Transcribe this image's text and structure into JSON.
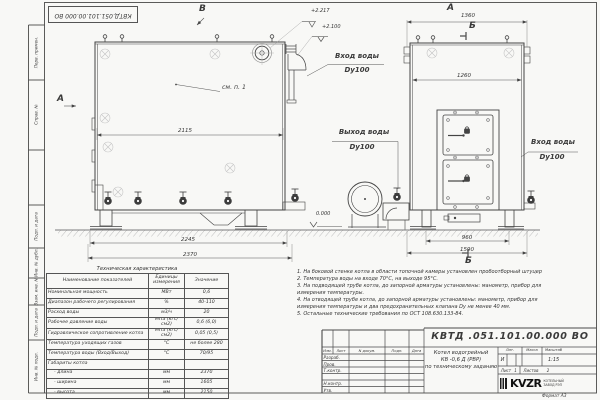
{
  "sheet": {
    "stamp_top": "КВТД.051.101.00.000 ВО",
    "format_label": "Формат  А3"
  },
  "frame_left": [
    "Перв. примен.",
    "Справ. №",
    "Подп. и дата",
    "Инв. № дубл.",
    "Взам. инв. №",
    "Подп. и дата",
    "Инв. № подл."
  ],
  "drawing": {
    "view_front": {
      "marker_top": "В",
      "marker_left": "А",
      "see_note": "см. п. 1",
      "elev_top1": "+2.217",
      "elev_top2": "+2.100",
      "elev_ground": "0.000",
      "dim_inner": "2115",
      "dim_base": "2245",
      "dim_overall": "2370"
    },
    "view_side": {
      "marker_top": "А",
      "marker_section_top": "Б",
      "marker_section_bottom": "Б",
      "dim_top": "1360",
      "dim_inner": "1260",
      "dim_base": "960",
      "dim_overall": "1590"
    },
    "labels": {
      "inlet_center": {
        "title": "Вход воды",
        "dn": "Dу100"
      },
      "outlet": {
        "title": "Выход воды",
        "dn": "Dу100"
      },
      "inlet_right": {
        "title": "Вход воды",
        "dn": "Dу100"
      }
    }
  },
  "tech_table": {
    "title": "Техническая характеристика",
    "headers": [
      "Наименование показателей",
      "Единицы измерения",
      "Значение"
    ],
    "rows": [
      {
        "name": "Номинальная мощность",
        "unit": "МВт",
        "value": "0,6"
      },
      {
        "name": "Диапазон рабочего регулирования",
        "unit": "%",
        "value": "40-110"
      },
      {
        "name": "Расход воды",
        "unit": "м3/ч",
        "value": "20"
      },
      {
        "name": "Рабочее давление воды",
        "unit": "МПа (кгс/см2)",
        "value": "0,6 (6,0)"
      },
      {
        "name": "Гидравлическое сопротивление котла",
        "unit": "МПа (кгс/см2)",
        "value": "0,05 (0,5)"
      },
      {
        "name": "Температура уходящих газов",
        "unit": "°С",
        "value": "не более 280"
      },
      {
        "name": "Температура воды (Вход/Выход)",
        "unit": "°С",
        "value": "70/95"
      },
      {
        "name": "Габариты котла",
        "unit": "",
        "value": ""
      },
      {
        "name": "- длина",
        "unit": "мм",
        "value": "2370"
      },
      {
        "name": "- ширина",
        "unit": "мм",
        "value": "1605"
      },
      {
        "name": "- высота",
        "unit": "мм",
        "value": "2150"
      }
    ]
  },
  "notes": [
    "1. На боковой стенке котла в области топочной камеры установлен пробоотборный штуцер",
    "2. Температура воды на входе 70°С, на выходе 95°С.",
    "3. На подводящей трубе котла, до запорной арматуры установлены: манометр, прибор для",
    "измерения температуры.",
    "4. На отводящей трубе котла, до запорной арматуры установлены: манометр, прибор для",
    "измерения температуры и два предохранительных клапана Dу не менее 40 мм.",
    "5. Остальные технические требования по ОСТ 108.630.133-84."
  ],
  "title_block": {
    "doc_number": "КВТД .051.101.00.000  ВО",
    "product_name_1": "Котел водогрейный",
    "product_name_2": "КВ -0,6  Д  (РВР)",
    "product_name_3": "по техническому заданию",
    "col_izm": "Изм.",
    "col_list": "Лист",
    "col_doc": "N докум.",
    "col_sign": "Подп.",
    "col_date": "Дата",
    "row_labels": [
      "Разраб.",
      "Пров.",
      "Т.контр.",
      "Н.контр.",
      "Утв."
    ],
    "lit_header": "Лит.",
    "mass_header": "Масса",
    "scale_header": "Масштаб",
    "lit_value": "И",
    "scale_value": "1:15",
    "sheet_label": "Лист",
    "sheet_value": "1",
    "sheets_label": "Листов",
    "sheets_value": "2",
    "logo_text": "KVZR",
    "logo_sub1": "КОТЕЛЬНЫЙ",
    "logo_sub2": "ЗАВОД РЭП"
  }
}
